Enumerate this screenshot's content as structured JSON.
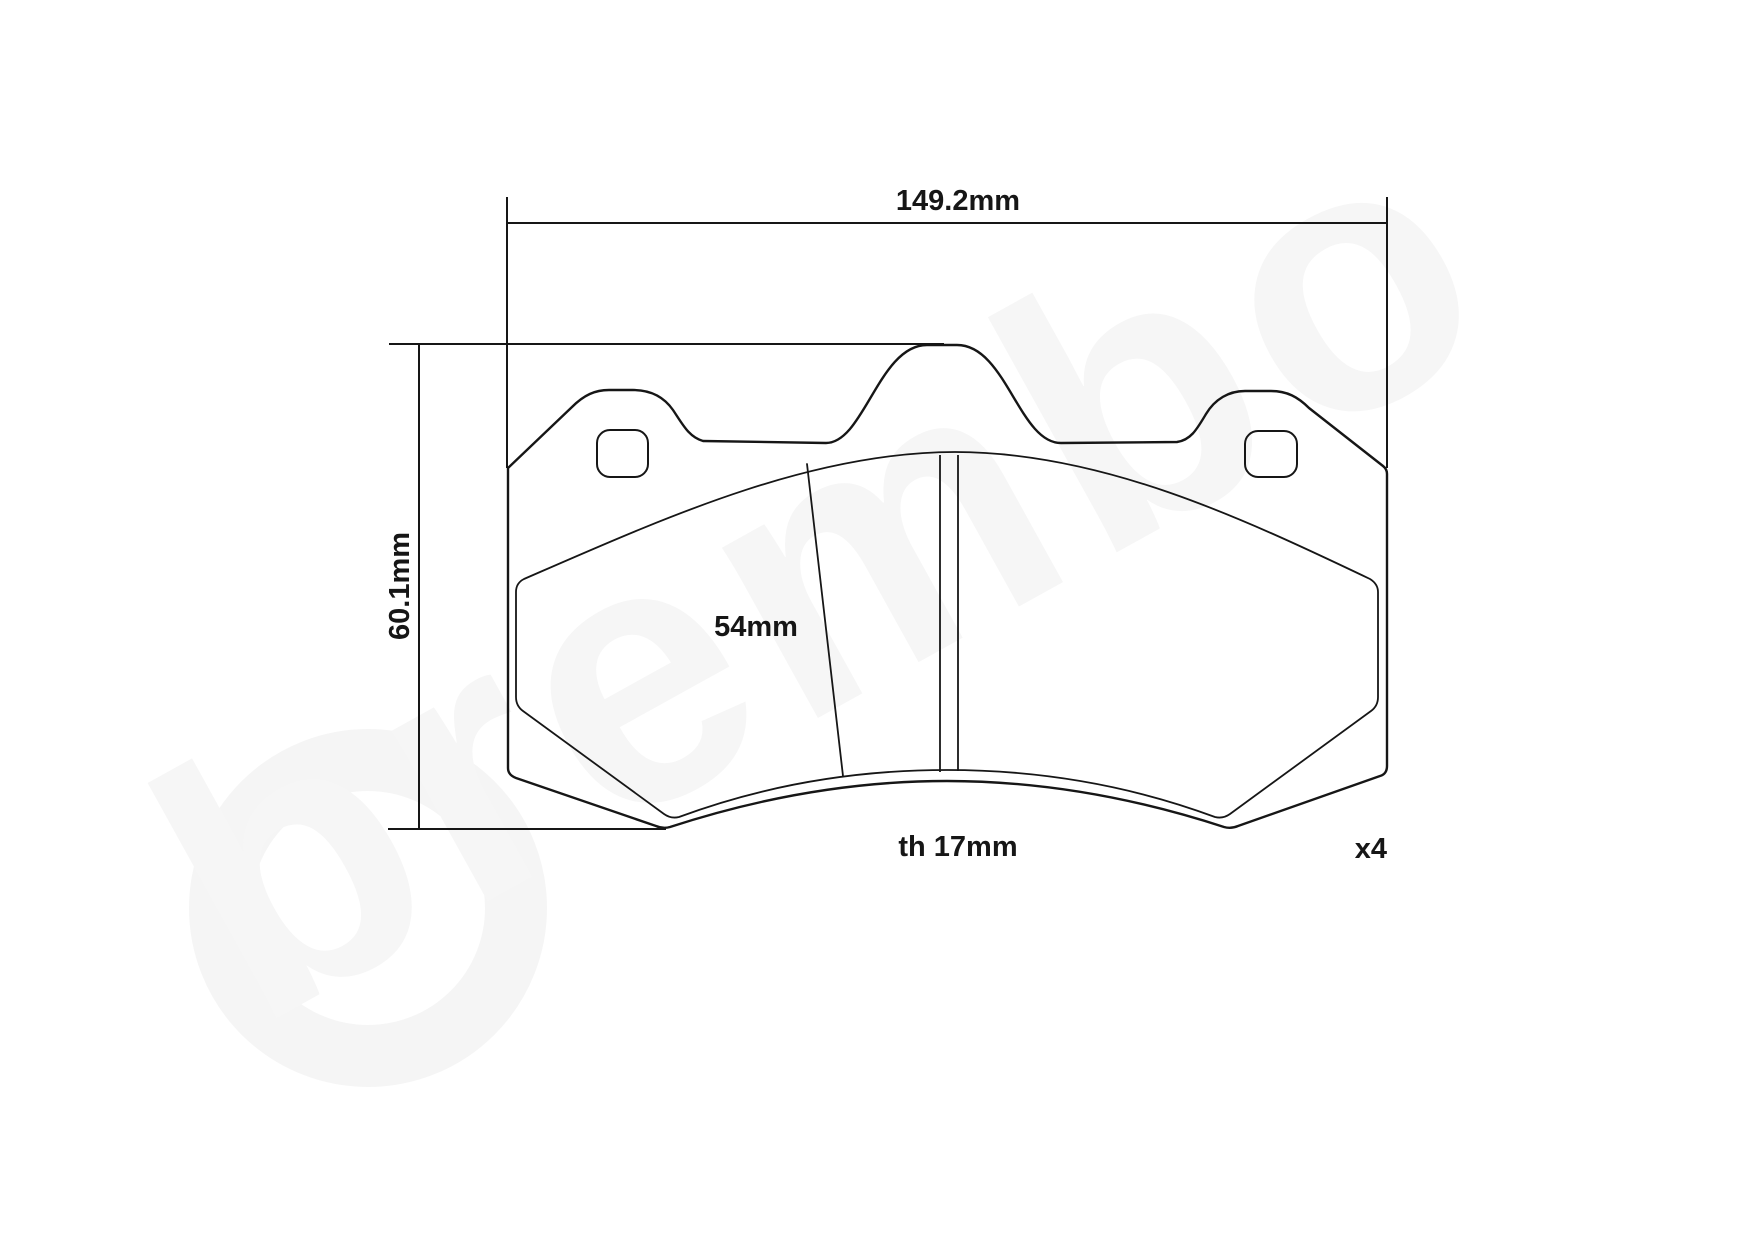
{
  "drawing": {
    "title": "brake-pad-technical-drawing",
    "dimensions": {
      "width_label": "149.2mm",
      "height_label": "60.1mm",
      "pad_height_label": "54mm",
      "thickness_label": "th 17mm",
      "quantity_label": "x4"
    },
    "watermark": {
      "text": "brembo"
    },
    "colors": {
      "line": "#161616",
      "background": "#ffffff",
      "watermark": "#f6f6f6"
    }
  }
}
